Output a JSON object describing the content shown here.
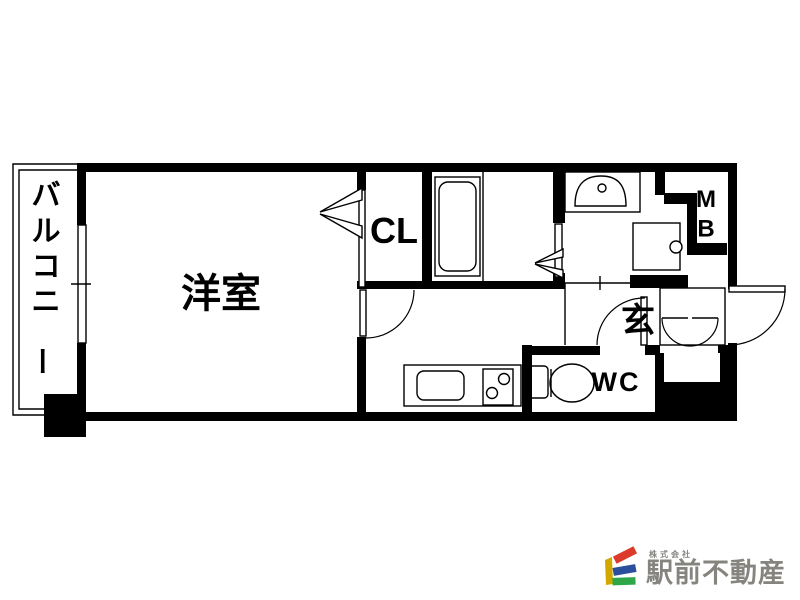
{
  "floor_plan": {
    "labels": {
      "balcony": "バルコニー",
      "western_room": "洋室",
      "closet": "CL",
      "entrance": "玄",
      "toilet": "WC",
      "meter_box": "MB"
    },
    "colors": {
      "wall": "#000000",
      "background": "#ffffff"
    }
  },
  "branding": {
    "company_prefix": "株式会社",
    "company_name": "駅前不動産",
    "colors": {
      "bar_yellow": "#d2a800",
      "bar_red": "#dc3b2c",
      "bar_blue": "#2b4f9c",
      "bar_green": "#2fa648",
      "text": "#85847e"
    }
  }
}
